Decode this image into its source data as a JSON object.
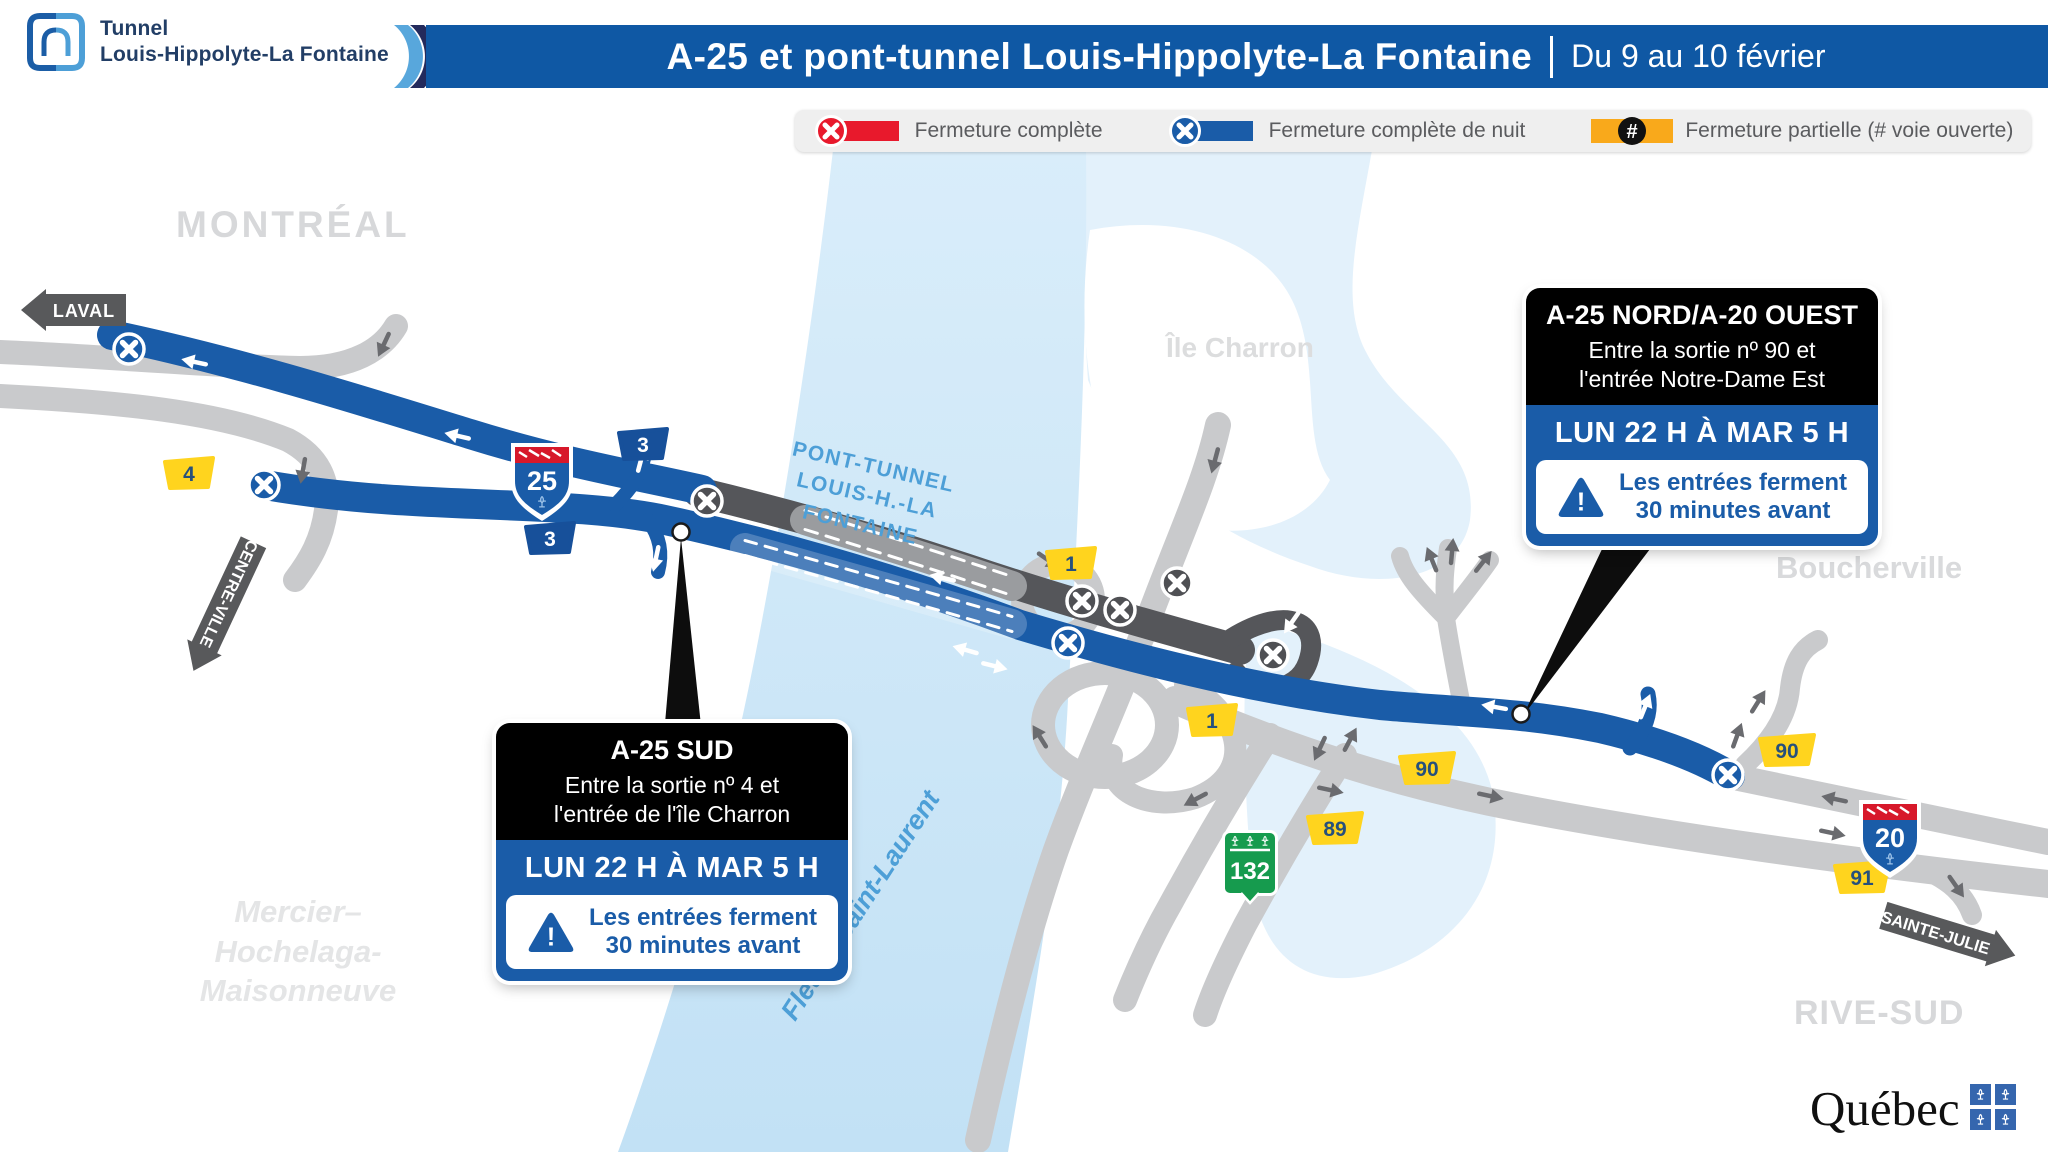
{
  "header": {
    "logo": {
      "line1": "Tunnel",
      "line2": "Louis-Hippolyte-La Fontaine"
    },
    "banner": {
      "title": "A-25 et pont-tunnel Louis-Hippolyte-La Fontaine",
      "date": "Du 9 au 10 février"
    }
  },
  "legend": {
    "full_closure": "Fermeture complète",
    "night_closure": "Fermeture complète de nuit",
    "partial_closure": "Fermeture partielle (# voie ouverte)",
    "partial_symbol": "#",
    "colors": {
      "full": "#E8192C",
      "night": "#1A5CA8",
      "partial": "#F9A91B"
    }
  },
  "map": {
    "labels": {
      "montreal": "MONTRÉAL",
      "ile_charron": "Île Charron",
      "boucherville": "Boucherville",
      "mercier_line1": "Mercier–",
      "mercier_line2": "Hochelaga-",
      "mercier_line3": "Maisonneuve",
      "rive_sud": "RIVE-SUD",
      "fleuve": "Fleuve Saint-Laurent",
      "tunnel_line1": "PONT-TUNNEL",
      "tunnel_line2": "LOUIS-H.-LA FONTAINE"
    },
    "signs": {
      "laval": "LAVAL",
      "centre_ville": "CENTRE-VILLE",
      "sainte_julie": "SAINTE-JULIE"
    },
    "shields": {
      "a25": "25",
      "a20": "20",
      "r132": "132"
    },
    "exits": {
      "e1": "1",
      "e3": "3",
      "e4": "4",
      "e89": "89",
      "e90": "90",
      "e91": "91"
    }
  },
  "callouts": {
    "sud": {
      "title": "A-25 SUD",
      "line1": "Entre la sortie nº 4 et",
      "line2": "l'entrée de l'île Charron",
      "schedule": "LUN 22 H À MAR 5 H",
      "warn1": "Les entrées ferment",
      "warn2": "30 minutes avant"
    },
    "nord": {
      "title": "A-25 NORD/A-20 OUEST",
      "line1": "Entre la sortie nº 90 et",
      "line2": "l'entrée Notre-Dame Est",
      "schedule": "LUN 22 H À MAR 5 H",
      "warn1": "Les entrées ferment",
      "warn2": "30 minutes avant"
    }
  },
  "footer": {
    "wordmark": "Québec"
  }
}
